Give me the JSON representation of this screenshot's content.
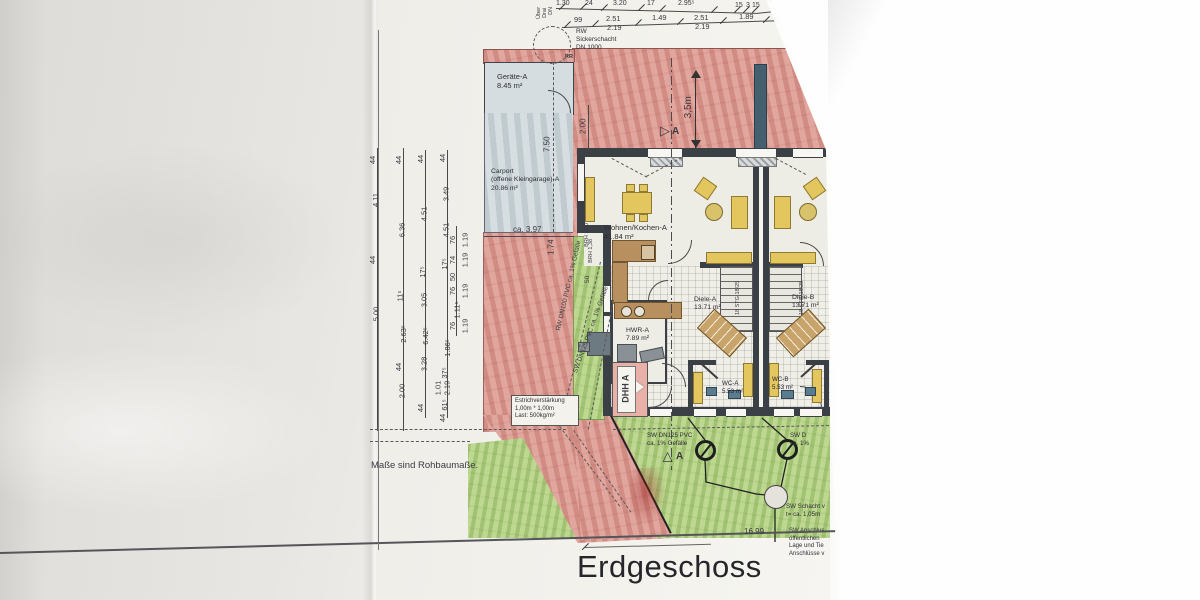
{
  "meta": {
    "title": "Erdgeschoss",
    "note": "Maße sind Rohbaumaße."
  },
  "colors": {
    "paving": "#dfa49b",
    "lawn": "#b9d48c",
    "carport": "#cdd6da",
    "furniture": "#e4c65e",
    "kitchen": "#b8905f",
    "wall": "#3b4046",
    "fixture": "#5b7c8e",
    "dhh_box": "#e9b0a8",
    "tile_floor": "#efeee7"
  },
  "rooms": {
    "geraete": {
      "name": "Geräte-A",
      "area": "8.45 m²"
    },
    "carport": {
      "name": "Carport",
      "name2": "(offene Kleingarage)-A",
      "area": "20.86 m²"
    },
    "wohnen": {
      "name": "Wohnen/Kochen-A",
      "area": "41.84 m²"
    },
    "hwr": {
      "name": "HWR-A",
      "area": "7.89 m²"
    },
    "diele_a": {
      "name": "Diele-A",
      "area": "13.71 m²"
    },
    "diele_b": {
      "name": "Diele-B",
      "area": "13.71 m²"
    },
    "wc_a": {
      "name": "WC-A",
      "area": "5.53 m²"
    },
    "wc_b": {
      "name": "WC-B",
      "area": "5.53 m²"
    }
  },
  "labels": {
    "dhh": "DHH A",
    "rr": "RR",
    "stairs_a": "18 STG 18/25",
    "stairs_b": "18 STG 18/25",
    "section_top": "A",
    "section_bottom": "A",
    "dim_35": "3,5m",
    "dim_200": "2.00",
    "dim_750": "7.50",
    "dim_ca397": "ca. 3.97",
    "dim_174": "1.74",
    "dim_50": "50",
    "brh_a": "BRH 1,00",
    "brh_b": "BRH 1,38",
    "grenz_len": "16.99"
  },
  "annotations": {
    "sicker_l1": "RW",
    "sicker_l2": "Sickerschacht",
    "sicker_l3": "DN 1000",
    "estrich_l1": "Estrichverstärkung",
    "estrich_l2": "1,00m * 1,00m",
    "estrich_l3": "Last: 500kg/m²",
    "rw_pipe": "RW DN100 PVC ca. 1% Gefälle",
    "sw_pipe": "SW DN125 PVC ca. 1% Gefälle",
    "sw_lawn_l1": "SW DN125 PVC",
    "sw_lawn_l2": "ca. 1% Gefälle",
    "sw_lawn_b_l1": "SW D",
    "sw_lawn_b_l2": "ca. 1%",
    "schacht_l1": "SW Schacht v",
    "schacht_l2": "t= ca. 1,05m",
    "anschluss_l1": "SW Anschlus",
    "anschluss_l2": "öffentlichen",
    "anschluss_l3": "Lage und Tie",
    "anschluss_l4": "Anschlüsse v",
    "top_vert_l1": "Über",
    "top_vert_l2": "Drai",
    "top_vert_l3": "DN"
  },
  "dim_row1": [
    {
      "v": "1.30",
      "x": 556,
      "y": 0
    },
    {
      "v": "24",
      "x": 585,
      "y": 0
    },
    {
      "v": "3.20",
      "x": 613,
      "y": 0
    },
    {
      "v": "17",
      "x": 647,
      "y": 0
    },
    {
      "v": "2.95⁵",
      "x": 678,
      "y": 0
    },
    {
      "v": "15",
      "x": 735,
      "y": 2
    },
    {
      "v": "3",
      "x": 746,
      "y": 2
    },
    {
      "v": "15",
      "x": 752,
      "y": 2
    },
    {
      "v": "2.95⁵",
      "x": 776,
      "y": 0
    }
  ],
  "dim_row2": [
    {
      "v": "99",
      "x": 574,
      "y": 16
    },
    {
      "v": "2.51",
      "x": 606,
      "y": 15
    },
    {
      "v": "2.19",
      "x": 607,
      "y": 24
    },
    {
      "v": "1.49",
      "x": 652,
      "y": 14
    },
    {
      "v": "2.51",
      "x": 694,
      "y": 14
    },
    {
      "v": "2.19",
      "x": 695,
      "y": 23
    },
    {
      "v": "1.89",
      "x": 739,
      "y": 13
    },
    {
      "v": "2.51",
      "x": 786,
      "y": 14
    },
    {
      "v": "2.19",
      "x": 787,
      "y": 23
    }
  ],
  "row2_ticks": [
    {
      "x": 563,
      "y": 24
    },
    {
      "x": 591,
      "y": 23
    },
    {
      "x": 634,
      "y": 22
    },
    {
      "x": 676,
      "y": 21
    },
    {
      "x": 719,
      "y": 20
    },
    {
      "x": 762,
      "y": 19
    },
    {
      "x": 822,
      "y": 17
    }
  ],
  "row1_ticks": [
    {
      "x": 558,
      "y": 6
    },
    {
      "x": 579,
      "y": 6
    },
    {
      "x": 600,
      "y": 7
    },
    {
      "x": 637,
      "y": 7
    },
    {
      "x": 658,
      "y": 8
    },
    {
      "x": 710,
      "y": 9
    },
    {
      "x": 733,
      "y": 9
    },
    {
      "x": 742,
      "y": 9
    },
    {
      "x": 751,
      "y": 9
    },
    {
      "x": 799,
      "y": 6
    }
  ],
  "chain_lines": [
    {
      "x": 377,
      "y": 148,
      "h": 283
    },
    {
      "x": 403,
      "y": 148,
      "h": 283
    },
    {
      "x": 425,
      "y": 150,
      "h": 268
    },
    {
      "x": 447,
      "y": 150,
      "h": 268
    },
    {
      "x": 456,
      "y": 226,
      "h": 110
    }
  ],
  "chain_labels": [
    {
      "v": "44",
      "x": 369,
      "y": 156
    },
    {
      "v": "4.11",
      "x": 369,
      "y": 196
    },
    {
      "v": "44",
      "x": 369,
      "y": 256
    },
    {
      "v": "5.00",
      "x": 369,
      "y": 310
    },
    {
      "v": "44",
      "x": 395,
      "y": 156
    },
    {
      "v": "6.36",
      "x": 395,
      "y": 226
    },
    {
      "v": "11⁵",
      "x": 395,
      "y": 292
    },
    {
      "v": "2.63⁵",
      "x": 395,
      "y": 330
    },
    {
      "v": "44",
      "x": 395,
      "y": 363
    },
    {
      "v": "2.00",
      "x": 395,
      "y": 387
    },
    {
      "v": "44",
      "x": 417,
      "y": 155
    },
    {
      "v": "4.51",
      "x": 417,
      "y": 210
    },
    {
      "v": "17⁵",
      "x": 417,
      "y": 268
    },
    {
      "v": "3.05",
      "x": 417,
      "y": 296
    },
    {
      "v": "6.42⁵",
      "x": 417,
      "y": 332
    },
    {
      "v": "3.28",
      "x": 417,
      "y": 360
    },
    {
      "v": "44",
      "x": 417,
      "y": 404
    },
    {
      "v": "44",
      "x": 439,
      "y": 154
    },
    {
      "v": "3.49",
      "x": 439,
      "y": 190
    },
    {
      "v": "4.51",
      "x": 439,
      "y": 226
    },
    {
      "v": "17⁵",
      "x": 439,
      "y": 260
    },
    {
      "v": "1.86⁵",
      "x": 439,
      "y": 344
    },
    {
      "v": "37⁵",
      "x": 439,
      "y": 369
    },
    {
      "v": "1.01",
      "x": 431,
      "y": 384
    },
    {
      "v": "2.19",
      "x": 440,
      "y": 384
    },
    {
      "v": "61⁵",
      "x": 439,
      "y": 401
    },
    {
      "v": "44",
      "x": 439,
      "y": 414
    },
    {
      "v": "76",
      "x": 449,
      "y": 236
    },
    {
      "v": "1.19",
      "x": 458,
      "y": 236
    },
    {
      "v": "74",
      "x": 449,
      "y": 256
    },
    {
      "v": "1.19",
      "x": 458,
      "y": 256
    },
    {
      "v": "50",
      "x": 449,
      "y": 273
    },
    {
      "v": "76",
      "x": 449,
      "y": 287
    },
    {
      "v": "1.19",
      "x": 458,
      "y": 287
    },
    {
      "v": "1.11⁵",
      "x": 449,
      "y": 306
    },
    {
      "v": "76",
      "x": 449,
      "y": 322
    },
    {
      "v": "1.19",
      "x": 458,
      "y": 322
    }
  ]
}
